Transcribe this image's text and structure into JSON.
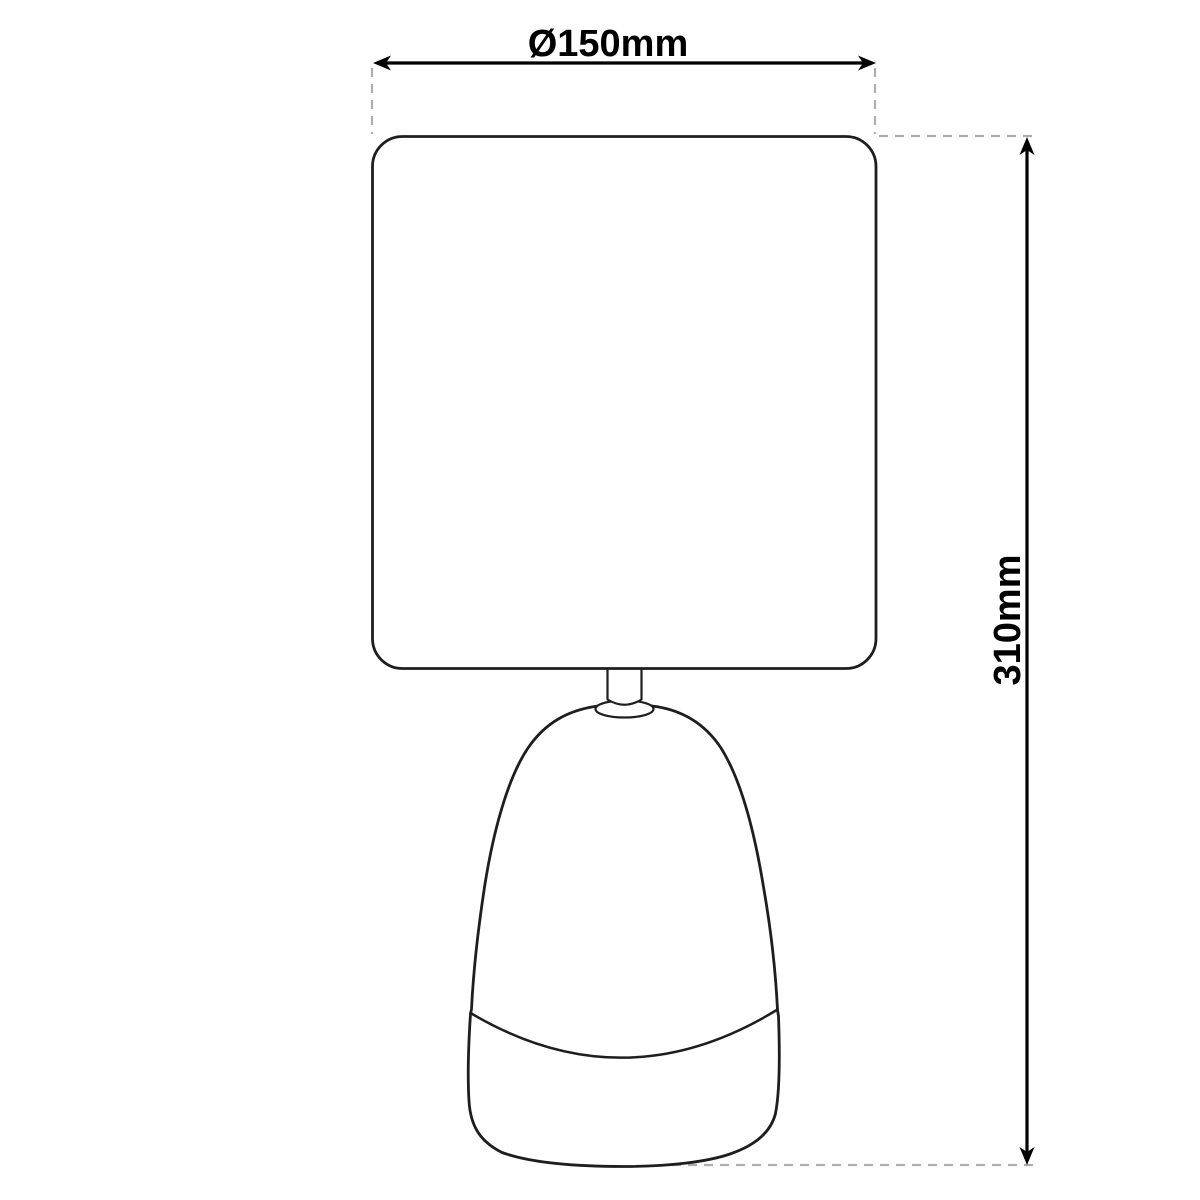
{
  "page": {
    "background": "#ffffff",
    "type": "technical-dimension-drawing",
    "subject": "table-lamp"
  },
  "colors": {
    "outline": "#1e1e1e",
    "dimension": "#000000",
    "extension_dashed": "#adadad",
    "label_text": "#000000"
  },
  "dimensions": {
    "width": {
      "label": "Ø150mm",
      "value_mm": 150,
      "symbol": "diameter",
      "orientation": "horizontal",
      "position": "top"
    },
    "height": {
      "label": "310mm",
      "value_mm": 310,
      "orientation": "vertical",
      "position": "right"
    }
  },
  "drawing": {
    "parts": [
      {
        "name": "lamp-shade",
        "shape": "rounded-square"
      },
      {
        "name": "socket-neck",
        "shape": "small-rectangle"
      },
      {
        "name": "socket-collar",
        "shape": "ellipse"
      },
      {
        "name": "lamp-base",
        "shape": "tapered-dome"
      },
      {
        "name": "base-seam",
        "shape": "curved-line"
      }
    ]
  }
}
